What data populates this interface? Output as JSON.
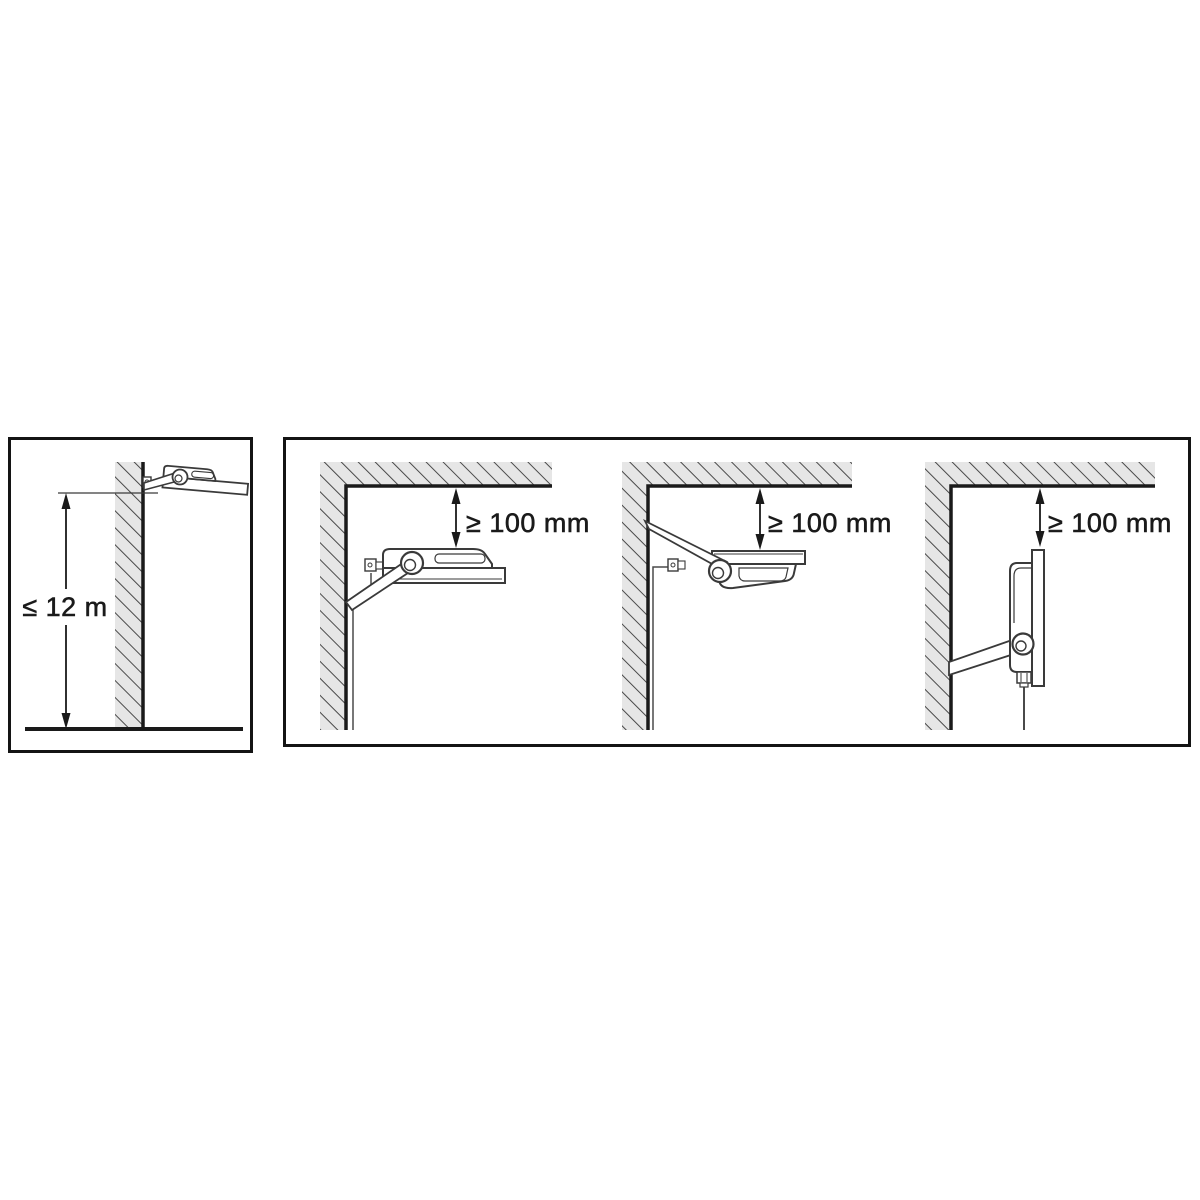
{
  "colors": {
    "background": "#ffffff",
    "drawing_line": "#3a3a3a",
    "structure_line": "#1a1a1a",
    "wall_fill": "#e6e6e6",
    "hatch_line": "#4a4a4a",
    "text": "#1a1a1a"
  },
  "height_panel": {
    "dimension_label": "≤ 12 m"
  },
  "clearance_panel": {
    "diagrams": [
      {
        "dimension_label": "≥ 100 mm"
      },
      {
        "dimension_label": "≥ 100 mm"
      },
      {
        "dimension_label": "≥ 100 mm"
      }
    ]
  }
}
